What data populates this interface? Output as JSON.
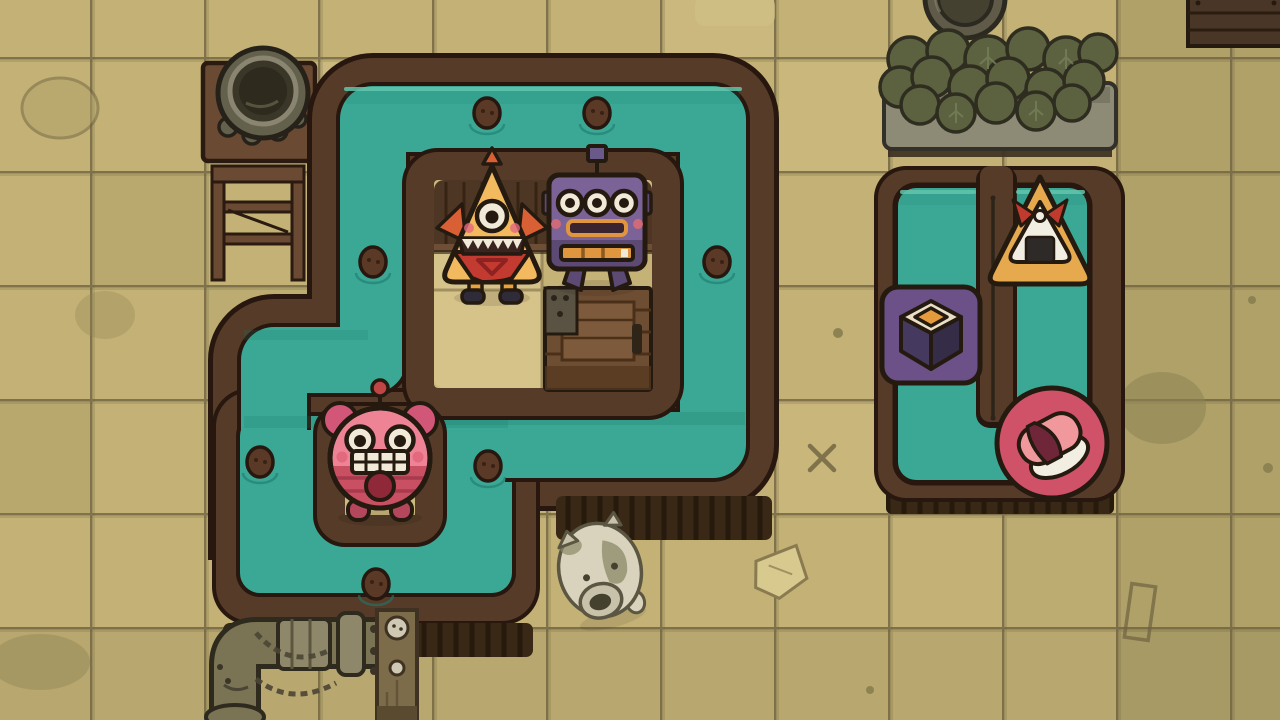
{
  "app": {
    "name": "sushi-canal-puzzle-screenshot",
    "canvas": {
      "width": 1280,
      "height": 720
    }
  },
  "palette": {
    "tile": "#c3b176",
    "tile-light": "#d2c086",
    "tile-dark": "#b0a269",
    "tile-olive": "#8d8352",
    "grout": "#6f6340",
    "water": "#3aa895",
    "water-hi": "#63c4ac",
    "water-sh": "#1f7a6c",
    "bank": "#553b28",
    "bank-dark": "#27170e",
    "skirt": "#3a2817",
    "skirt-line": "#20150b",
    "island": "#ccba7f",
    "island-light": "#d5c38a",
    "island-mid": "#c4b277",
    "counter": "#4e3624",
    "counter-line": "#31200f",
    "counter-lip": "#6e4f36",
    "crate": "#6e4e33",
    "crate-lid": "#7d5a3b",
    "crate-line": "#4a3018",
    "crate-metal": "#5a5243",
    "outline": "#241a10",
    "tri-body": "#f3b95e",
    "tri-spike": "#d95f35",
    "tri-leg": "#e8a33d",
    "tri-boot": "#2f2b38",
    "tri-bib": "#c23a30",
    "tri-bib-dark": "#8e2220",
    "robot-body": "#7b6397",
    "robot-lower": "#5c4a74",
    "robot-accent": "#e0953f",
    "robot-cheek": "#cf6a7a",
    "robot-foot": "#5c4a74",
    "robot-mouth": "#3a2430",
    "pink-body": "#ee8396",
    "pink-lower": "#c94f63",
    "pink-stripe": "#a83a4e",
    "pink-ear": "#d15677",
    "pink-belly": "#8f2838",
    "pink-foot": "#b5475c",
    "pink-cheek": "#e2697e",
    "pink-ball": "#c04545",
    "white": "#f2ead8",
    "sign-onigiri": "#e7a94e",
    "sign-maki": "#6b5187",
    "sign-sushi": "#d05268",
    "nori": "#2e2a28",
    "rice": "#f2eee2",
    "ribbon": "#c13a2e",
    "maki-top": "#eadfc6",
    "maki-center": "#e59b3c",
    "maki-left": "#463960",
    "maki-right": "#352c48",
    "fish": "#f0989c",
    "fish-band": "#6e2638",
    "pig-body": "#d9d3bd",
    "pig-patch": "#8b8a68",
    "pig-snout": "#c9c2aa",
    "pig-line": "#5a5642",
    "pig-dark": "#45412f",
    "metal": "#7a7354",
    "metal-light": "#8f8769",
    "metal-dark": "#2e2a1e",
    "pot": "#63604c",
    "pot-inner": "#3a3628",
    "pot-rim": "#8a8570",
    "wood": "#6b4a33",
    "wood-dark": "#2a1a10",
    "trough": "#8d8a76",
    "leaf": "#5c6140",
    "leaf-line": "#2e2d20",
    "post-wood": "#7d6c4a",
    "bolt": "#cfc9b4"
  },
  "characters": {
    "triangle_monster": {
      "label": "one-eyed triangle monster customer",
      "x": 492,
      "y": 230
    },
    "robot_monster": {
      "label": "purple three-eyed robot monster customer",
      "x": 597,
      "y": 222
    },
    "pink_monster": {
      "label": "pink grinning round monster customer",
      "x": 380,
      "y": 458
    },
    "pig": {
      "label": "pale pig critter",
      "x": 600,
      "y": 570,
      "rotate": -15
    }
  },
  "signs": {
    "onigiri": {
      "label": "onigiri order sign",
      "x": 1040,
      "y": 232
    },
    "maki": {
      "label": "maki roll cube order sign",
      "x": 931,
      "y": 335
    },
    "sushi": {
      "label": "nigiri sushi order sign",
      "x": 1052,
      "y": 443
    }
  },
  "props": {
    "cauldron": {
      "label": "cauldron on table",
      "x": 258,
      "y": 95
    },
    "stand": {
      "label": "wooden stand",
      "x": 258,
      "y": 218
    },
    "planter": {
      "label": "stone planter with leaves",
      "x": 1000,
      "y": 99
    },
    "barrel": {
      "label": "barrel top at screen edge",
      "x": 965,
      "y": -2
    },
    "corner_crate": {
      "label": "crate at top right corner",
      "x": 1236,
      "y": 20
    },
    "crate": {
      "label": "wooden crate on island",
      "x": 598,
      "y": 340
    },
    "pipes": {
      "label": "pipe elbow assembly",
      "x": 300,
      "y": 655
    },
    "post": {
      "label": "bolted wooden post",
      "x": 397,
      "y": 662
    }
  },
  "pebbles": [
    [
      487,
      113
    ],
    [
      597,
      113
    ],
    [
      373,
      262
    ],
    [
      717,
      262
    ],
    [
      260,
      462
    ],
    [
      488,
      466
    ],
    [
      376,
      584
    ]
  ]
}
